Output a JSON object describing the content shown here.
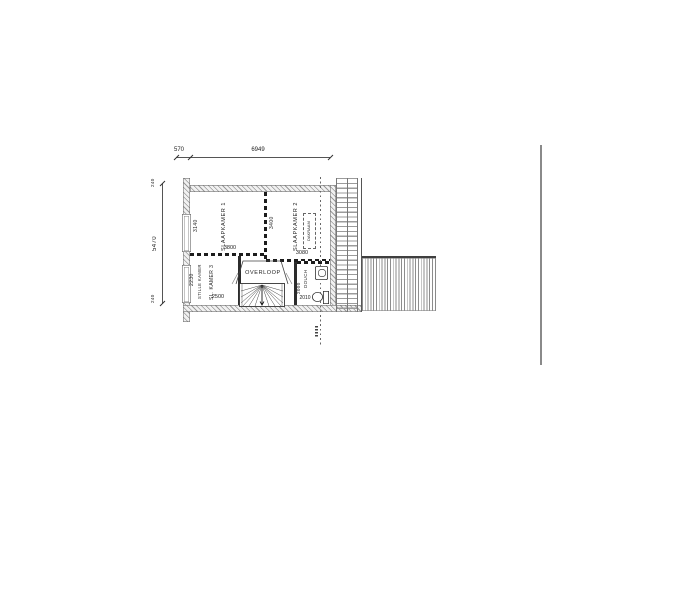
{
  "plan": {
    "dims": {
      "top_offset": "570",
      "top_total": "6949",
      "left_total": "5470",
      "left_top": "240",
      "left_bottom": "240"
    },
    "bedroom1": {
      "name": "SLAAPKAMER 1",
      "width": "3800",
      "depth": "3140"
    },
    "bedroom2": {
      "name": "SLAAPKAMER 2",
      "width": "3080",
      "depth": "3400"
    },
    "room3": {
      "name": "SL. KAMER 3",
      "alt": "STILLE KAMER",
      "width": "2500",
      "depth": "2230"
    },
    "landing": {
      "name": "OVERLOOP"
    },
    "shower": {
      "name": "DOUCH",
      "width": "2010",
      "depth": "2000"
    },
    "skylight": {
      "name": "DAKRAAM"
    }
  }
}
